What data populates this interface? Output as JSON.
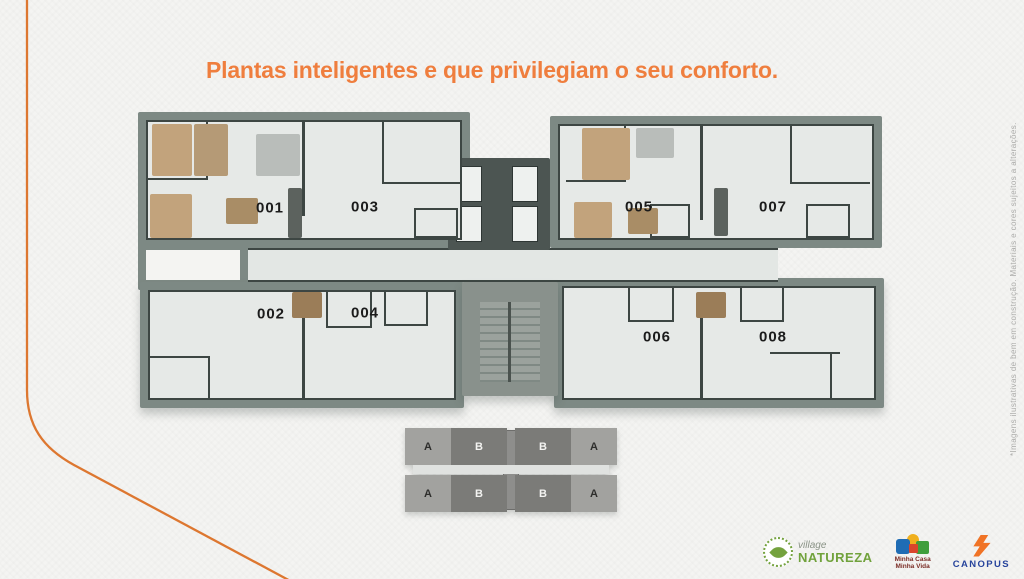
{
  "title": {
    "text": "Plantas inteligentes e que privilegiam o seu conforto."
  },
  "floor_plan": {
    "units": [
      {
        "label": "001"
      },
      {
        "label": "002"
      },
      {
        "label": "003"
      },
      {
        "label": "004"
      },
      {
        "label": "005"
      },
      {
        "label": "006"
      },
      {
        "label": "007"
      },
      {
        "label": "008"
      }
    ]
  },
  "key_plan": {
    "rows": [
      {
        "blocks": [
          "A",
          "B",
          "B",
          "A"
        ]
      },
      {
        "blocks": [
          "A",
          "B",
          "B",
          "A"
        ]
      }
    ]
  },
  "disclaimer": "*Imagens ilustrativas de bem em construção. Materiais e cores sujeitos a alterações.",
  "logos": {
    "village_natureza": {
      "script": "village",
      "name": "NATUREZA"
    },
    "minha_casa_minha_vida": {
      "line1": "Minha Casa",
      "line2": "Minha Vida"
    },
    "canopus": {
      "name": "CANOPUS"
    }
  },
  "colors": {
    "accent_orange": "#ef7e3e",
    "curve_orange": "#dd7730",
    "plan_mass": "#7d8984",
    "plan_wall": "#3d4643",
    "plan_floor": "#e6e9e7",
    "keyplan_block_a": "#a2a29f",
    "keyplan_block_b": "#7b7b78",
    "village_green": "#71a23c",
    "mcmv_red": "#7b2d26",
    "canopus_blue": "#27449c",
    "canopus_orange": "#f07325"
  }
}
